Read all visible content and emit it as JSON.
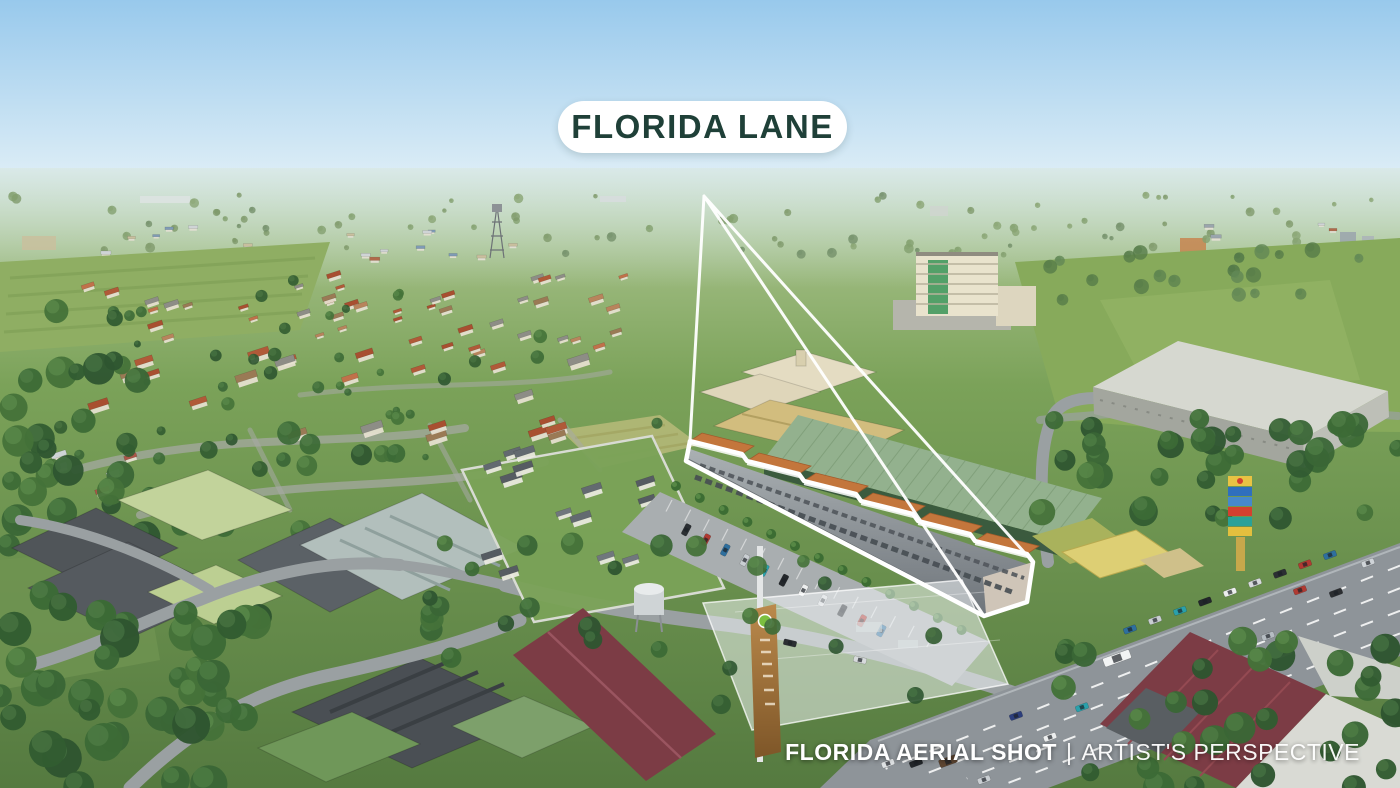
{
  "overlay": {
    "location_label": "FLORIDA LANE",
    "caption": {
      "bold": "FLORIDA AERIAL SHOT",
      "separator": "|",
      "regular": "ARTIST'S PERSPECTIVE"
    }
  },
  "colors": {
    "label_bg": "#ffffff",
    "label_text": "#1f4038",
    "caption_text": "#ffffff",
    "callout": "#ffffff",
    "sky_top": "#98c9ec",
    "sky_horizon": "#e2f0f7",
    "land_far": "#b7cd9c",
    "land_near": "#557a40",
    "field_green": "#87aa5b",
    "forest_green": "#3a6636",
    "strip_roof": "#c3763c",
    "strip_facade": "#969ca0",
    "green_warehouse_roof": "#93b18e",
    "warehouse_roof": "#d6d8d0",
    "highway_gray": "#8e9499",
    "maroon_roof": "#7c3c45",
    "gas_pylon_yellow": "#e9c343",
    "future_massing_white": "#f4f7f9"
  }
}
